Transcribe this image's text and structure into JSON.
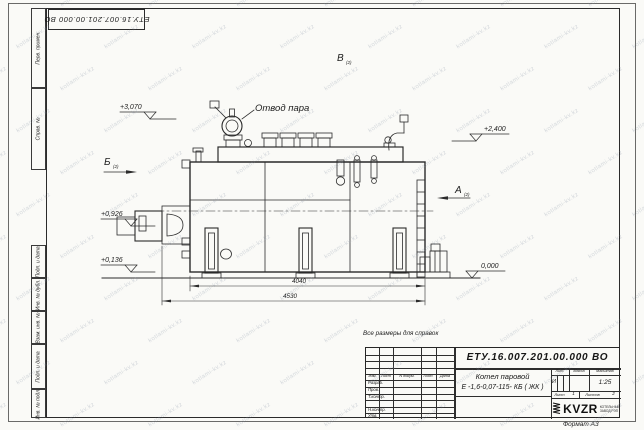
{
  "sheet": {
    "format_note": "Формат А3",
    "watermark": "kotlami-kv.kz",
    "reference_note": "Все размеры для справок"
  },
  "top_stamp": {
    "doc_number": "ЕТУ.16.007.201.00.000  ВО"
  },
  "margin_columns": {
    "first_application": "Перв. примен.",
    "reference_number": "Справ. №",
    "bottom": [
      "Подп. и дата",
      "Инв. № дубл.",
      "Взам. инв. №",
      "Подп. и дата",
      "Инв. № подл."
    ]
  },
  "drawing": {
    "steam_outlet_label": "Отвод пара",
    "view_b": "Б",
    "view_b_ref": "(2)",
    "view_v": "В",
    "view_v_ref": "(2)",
    "view_a": "А",
    "view_a_ref": "(2)",
    "elev_3070": "+3,070",
    "elev_2400": "+2,400",
    "elev_0926": "+0,926",
    "elev_0136": "+0,136",
    "elev_0000": "0,000",
    "dim_inner": "4040",
    "dim_outer": "4530"
  },
  "title_block": {
    "doc_number": "ЕТУ.16.007.201.00.000  ВО",
    "product_line1": "Котел паровой",
    "product_line2": "Е -1,6-0,07-115- КБ ( ЖК )",
    "header": {
      "izm": "Изм.",
      "list": "Лист",
      "doc": "N докум.",
      "podp": "Подп.",
      "data": "Дата"
    },
    "rows": [
      "Разраб.",
      "Пров.",
      "Т.контр.",
      "Н.контр.",
      "Утв."
    ],
    "lit_label": "Лит.",
    "lit_value": "И",
    "mass_label": "Масса",
    "scale_label": "Масштаб",
    "scale_value": "1:25",
    "sheet_label": "Лист",
    "sheet_no": "1",
    "sheets_label": "Листов",
    "sheets_total": "2",
    "logo_text": "KVZR",
    "company_line1": "КОТЕЛЬНЫЙ",
    "company_line2": "ЗАВОД РЭП"
  }
}
